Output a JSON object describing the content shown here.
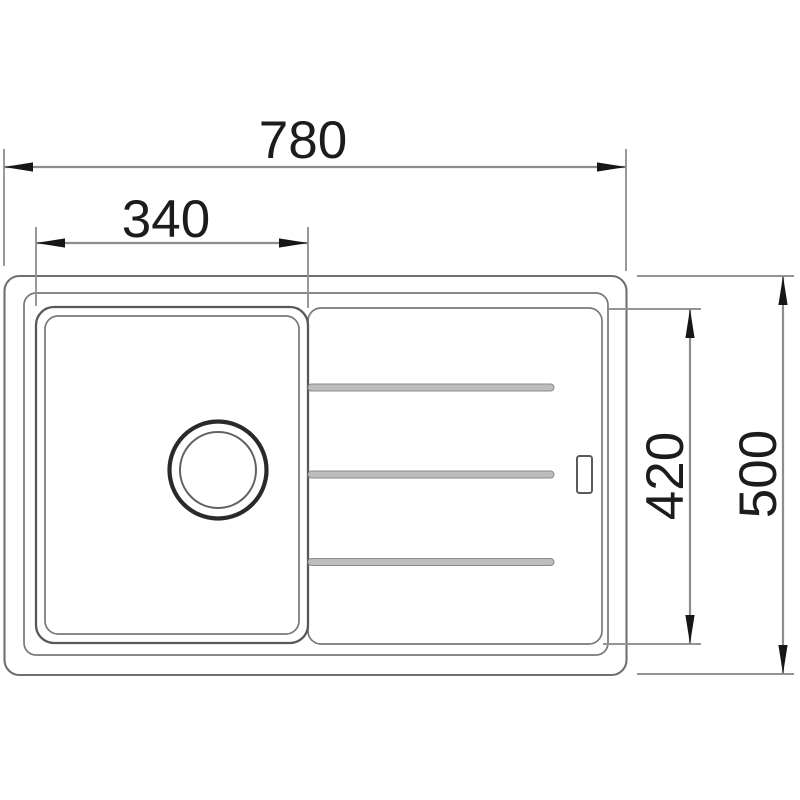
{
  "drawing": {
    "kind": "sink-top-view-dimension-drawing",
    "dimensions": {
      "overall_width": {
        "label": "780",
        "value": 780,
        "orientation": "horizontal"
      },
      "bowl_width": {
        "label": "340",
        "value": 340,
        "orientation": "horizontal"
      },
      "inner_depth": {
        "label": "420",
        "value": 420,
        "orientation": "vertical"
      },
      "overall_depth": {
        "label": "500",
        "value": 500,
        "orientation": "vertical"
      }
    },
    "features": {
      "groove_count": 3,
      "bowl": "square-bowl-with-round-drain",
      "drainboard": "ribbed-drainboard",
      "overflow_slot": "small-slot-right-inner-edge"
    },
    "colors": {
      "background": "#ffffff",
      "outline": "#6f6f6f",
      "bowl_outline": "#585858",
      "drain_outline": "#2a2a2a",
      "dimension_line": "#8d8d8d",
      "arrow": "#161616",
      "text": "#1c1c1c",
      "groove_fill": "#bdbdbd"
    }
  }
}
